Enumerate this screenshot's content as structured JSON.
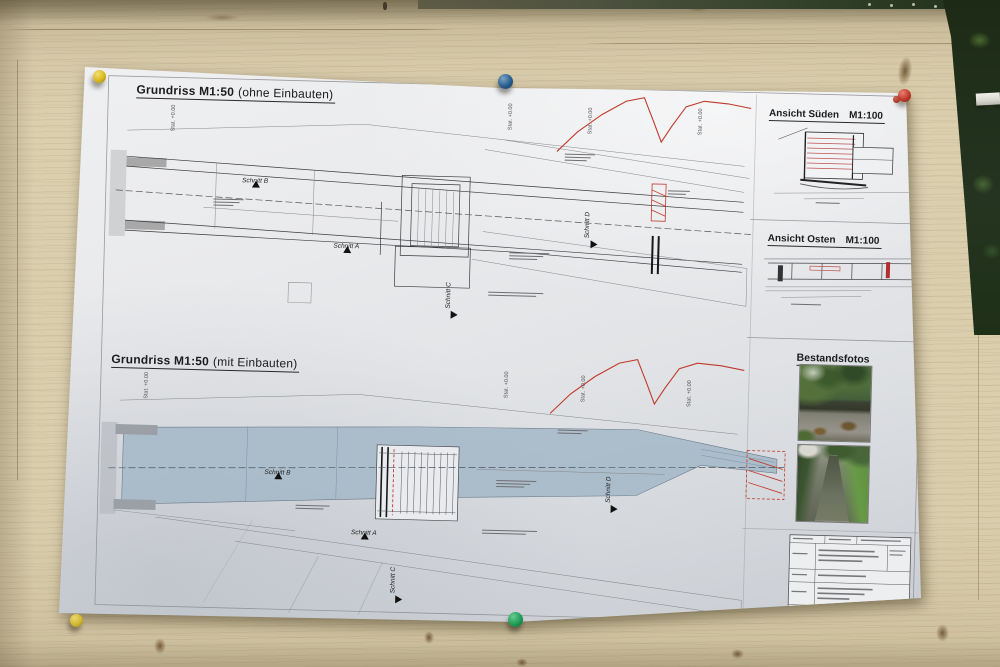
{
  "paper": {
    "plan_top": {
      "title": "Grundriss M1:50",
      "suffix": "(ohne Einbauten)"
    },
    "plan_bottom": {
      "title": "Grundriss M1:50",
      "suffix": "(mit Einbauten)"
    },
    "view_south": {
      "title": "Ansicht Süden",
      "scale": "M1:100"
    },
    "view_east": {
      "title": "Ansicht Osten",
      "scale": "M1:100"
    },
    "photos_heading": "Bestandsfotos",
    "section_labels": {
      "a": "Schnitt A",
      "b": "Schnitt B",
      "c": "Schnitt C",
      "d": "Schnitt D"
    },
    "station_label": "Stat. +0.00"
  },
  "pins": {
    "top_left": "yellow",
    "top_center": "blue",
    "top_right": "red",
    "bottom_left": "yellow",
    "bottom_center": "green"
  },
  "palette": {
    "wood": "#d6c9a8",
    "paper": "#e9eaec",
    "water_fill": "#a7bac9",
    "red_line": "#c0392b",
    "pin_yellow": "#d9b91c",
    "pin_blue": "#275d8e",
    "pin_red": "#c0392b",
    "pin_green": "#1d9e56",
    "foliage": "#243420"
  }
}
